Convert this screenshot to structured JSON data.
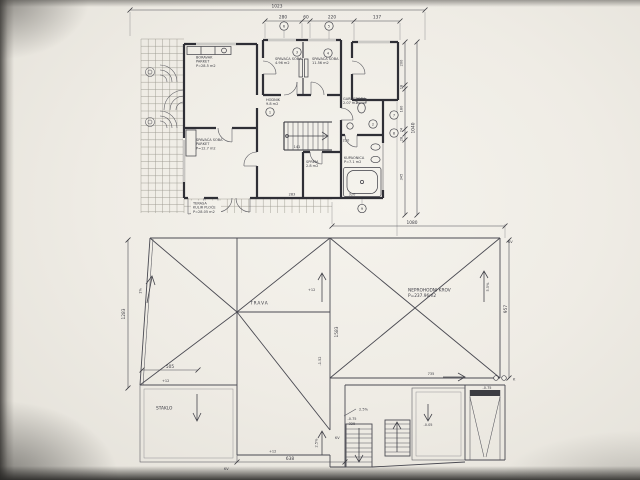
{
  "drawing": {
    "dims": {
      "top_overall": "1023",
      "top_seg_1": "280",
      "top_seg_2": "60",
      "top_seg_3": "220",
      "top_seg_4": "137",
      "right_seg_1": "200",
      "right_seg_2": "18",
      "right_seg_3": "180",
      "right_seg_4": "24",
      "right_seg_5": "28",
      "right_seg_6": "345",
      "right_overall": "1040",
      "plan_width_lower": "1080",
      "roof_right_height": "957",
      "roof_left_height": "1283",
      "roof_left_width": "505",
      "roof_bottom_width": "638",
      "roof_center_height": "1583",
      "stair_run": "325",
      "ramp_run": "735",
      "inner_dim_1": "141",
      "inner_dim_2": "283",
      "inner_dim_3": "320",
      "inner_dim_4": "220"
    },
    "levels": {
      "plus12_a": "+12",
      "plus12_b": "+12",
      "plus12_c": "+12",
      "minus075_stair": "-0.75",
      "minus075_ramp": "-0.75",
      "minus152": "-1.52",
      "minus005": "-0.05"
    },
    "slopes": {
      "s1": "2.5%",
      "s2": "2.5%",
      "s3": "5.5%",
      "s4": "1%"
    },
    "marks": {
      "kv_a": "KV",
      "kv_b": "KV",
      "kv_c": "KV",
      "k": "K",
      "c1": "1",
      "c2": "2",
      "c3": "3",
      "c4": "4",
      "c5": "5",
      "c6": "6",
      "c7": "7",
      "c8": "8",
      "c9": "9"
    },
    "roof": {
      "name_line1": "NEPROHODNI KROV",
      "name_line2": "P=237.96m2",
      "grass": "TRAVA",
      "glass": "STAKLO"
    },
    "rooms": {
      "living_1": "BORAVAK",
      "living_2": "PARKET",
      "living_3": "P=28.5 m2",
      "bed1_1": "SPAVAĆA SOBA",
      "bed1_2": "4.96 m2",
      "bed2_1": "SPAVAĆA SOBA",
      "bed2_2": "11.56 m2",
      "hall_1": "HODNIK",
      "hall_2": "9.8 m2",
      "ward_1": "GARDEROBA",
      "ward_2": "2.07 m2",
      "bath_1": "KUPAONICA",
      "bath_2": "P=7.1 m2",
      "bed3_1": "SPAVAĆA SOBA",
      "bed3_2": "PARKET",
      "bed3_3": "P=12.7 m2",
      "store_1": "SPREM.",
      "store_2": "2.8 m2",
      "terrace_1": "TERASA",
      "terrace_2": "KULIR PLOČE",
      "terrace_3": "P=28.05 m2"
    }
  }
}
